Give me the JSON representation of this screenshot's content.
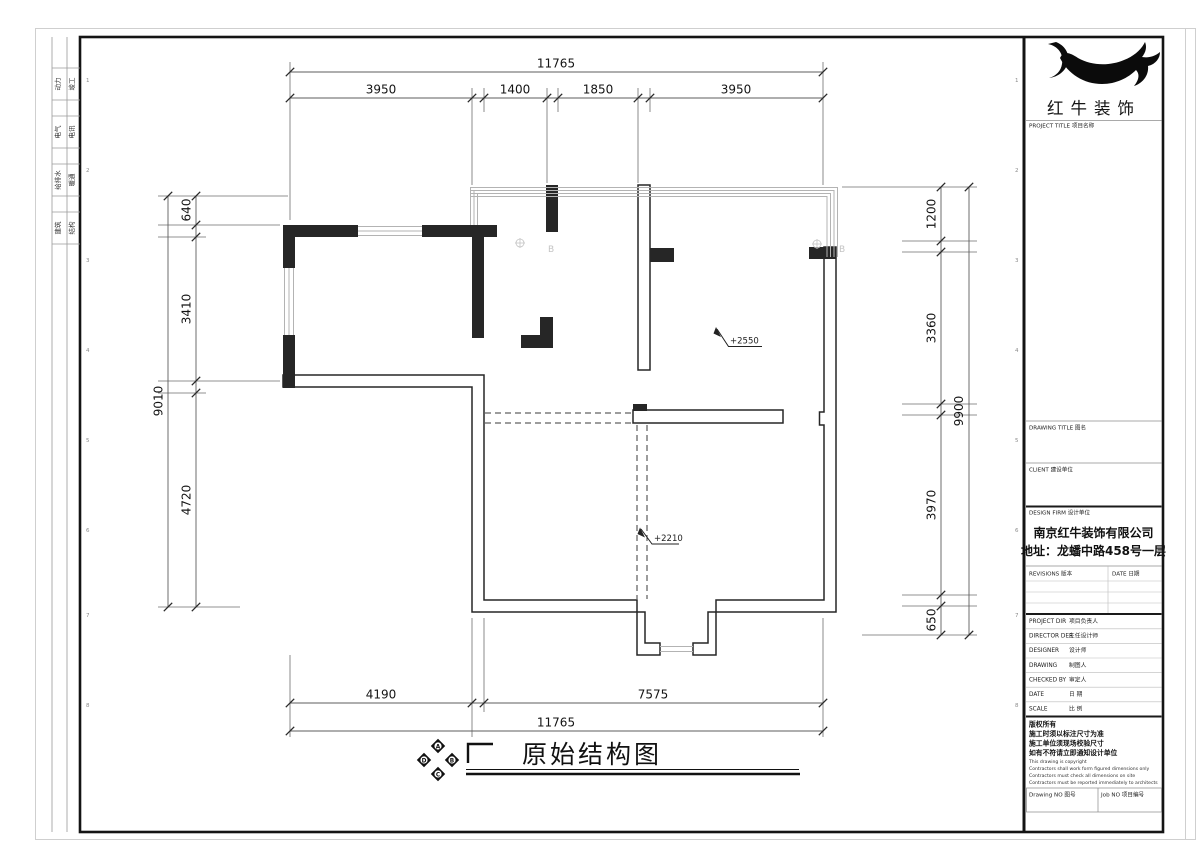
{
  "sheet": {
    "strip_rows": [
      [
        "动力",
        "竣工"
      ],
      [
        "电气",
        "电讯"
      ],
      [
        "给排水",
        "暖通"
      ],
      [
        "建筑",
        "结构"
      ]
    ],
    "grid_numbers": [
      "1",
      "2",
      "3",
      "4",
      "5",
      "6",
      "7",
      "8"
    ]
  },
  "title_block": {
    "logo_text": "红牛装饰",
    "project_title_label": "PROJECT TITLE  项目名称",
    "drawing_title_label": "DRAWING TITLE  图名",
    "client_label": "CLIENT  建设单位",
    "design_firm_label": "DESIGN FIRM  设计单位",
    "firm_name": "南京红牛装饰有限公司",
    "firm_address": "地址：龙蟠中路458号一层",
    "revisions_label": "REVISIONS  版本",
    "date_label": "DATE  日期",
    "personnel_rows": [
      {
        "en": "PROJECT DIR",
        "cn": "项目负责人"
      },
      {
        "en": "DIRECTOR DER",
        "cn": "主任设计师"
      },
      {
        "en": "DESIGNER",
        "cn": "设计师"
      },
      {
        "en": "DRAWING",
        "cn": "制图人"
      },
      {
        "en": "CHECKED BY",
        "cn": "审定人"
      },
      {
        "en": "DATE",
        "cn": "日  期"
      },
      {
        "en": "SCALE",
        "cn": "比  例"
      }
    ],
    "copyright_cn": [
      "版权所有",
      "施工时须以标注尺寸为准",
      "施工单位须现场校验尺寸",
      "如有不符请立即通知设计单位"
    ],
    "copyright_en": [
      "This drawing is copyright",
      "Contractors shall work form figured dimensions only",
      "Contractors must check all dimensions on site",
      "Contractors must be reported immediately to architects"
    ],
    "drawing_no_label": "Drawing NO  图号",
    "job_no_label": "Job NO  项目编号"
  },
  "plan": {
    "title": "原始结构图",
    "annotations": {
      "upper": "+2550",
      "lower": "+2210"
    },
    "compass": {
      "top": "A",
      "right": "B",
      "bottom": "C",
      "left": "D"
    },
    "flue_label": "B"
  },
  "dims": {
    "top": {
      "overall": "11765",
      "segments": [
        "3950",
        "1400",
        "1850",
        "3950"
      ]
    },
    "bottom": {
      "overall": "11765",
      "segments": [
        "4190",
        "7575"
      ]
    },
    "left": {
      "overall": "9010",
      "segments": [
        "640",
        "3410",
        "4720"
      ]
    },
    "right": {
      "overall": "9900",
      "segments": [
        "1200",
        "3360",
        "3970",
        "650"
      ]
    }
  },
  "colors": {
    "wall": "#262626",
    "glazing": "#b3b3b3",
    "dim_line": "#666666",
    "text": "#111111"
  }
}
